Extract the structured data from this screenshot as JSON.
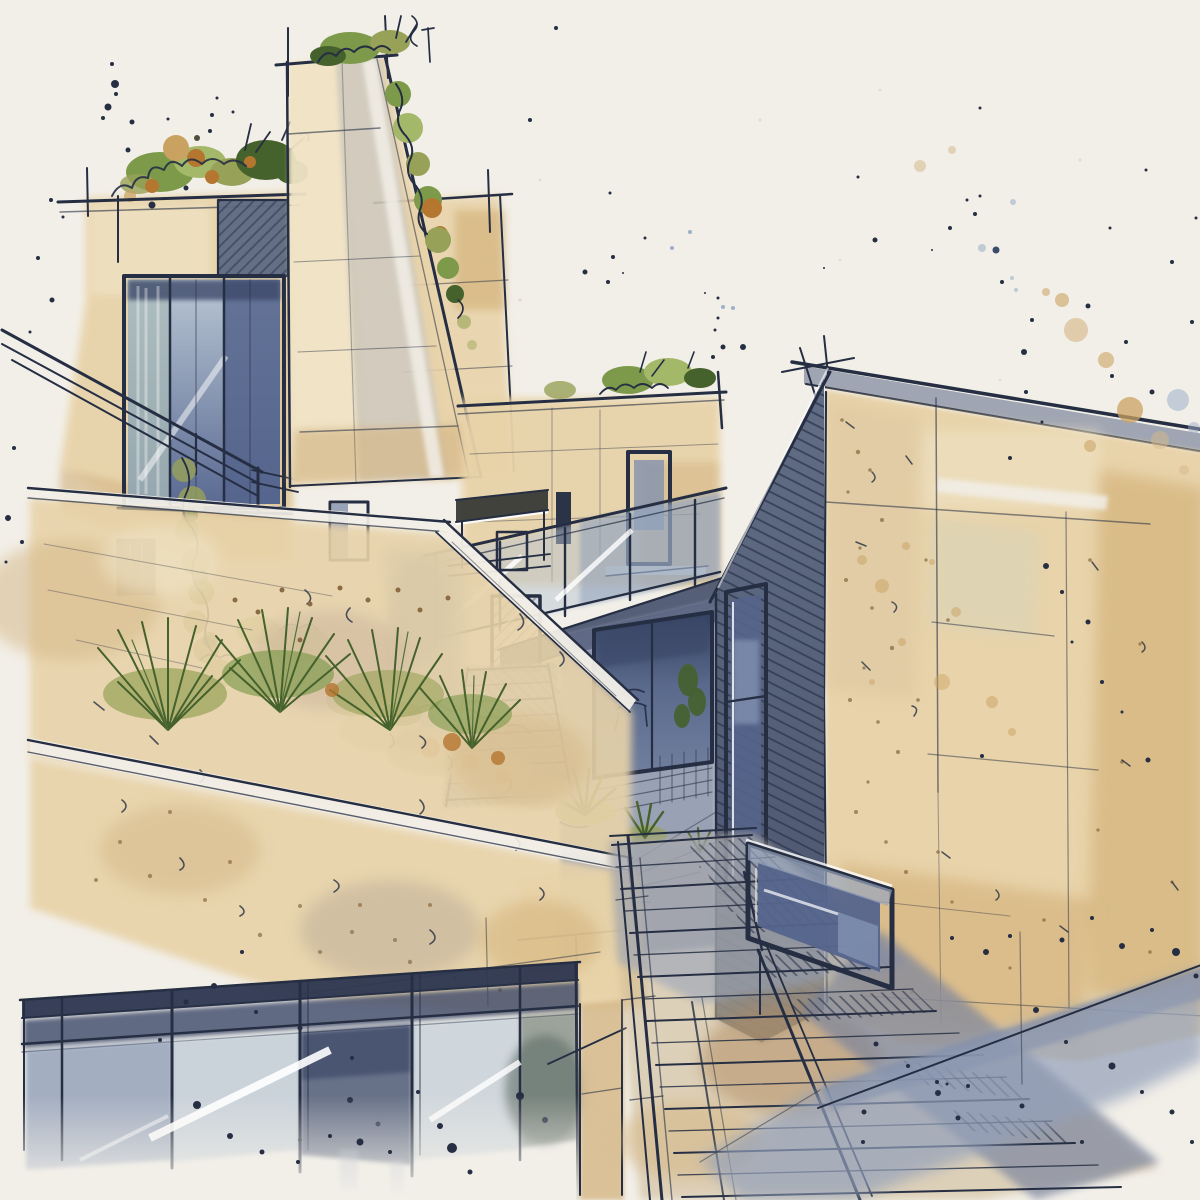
{
  "artwork": {
    "type": "watercolor architectural sketch",
    "subject": "Ink and watercolor concept sketch of a modern terraced hillside house with stacked stone volumes, a tall chimney tower, roof gardens, glass balustrades, a dark wood-clad wing and long exterior stairs",
    "style": "loose pen line work over watercolor washes with paint splatter accents on warm off-white paper",
    "text_content": "none"
  },
  "palette": {
    "paper": "#f2efe8",
    "speck": "#ddd6c6",
    "ink": "#252e42",
    "tan_light": "#f0e3c5",
    "tan": "#e8d3a9",
    "tan_deep": "#d6b98a",
    "ochre": "#c9a161",
    "rust": "#b5762f",
    "brown": "#8a6b42",
    "grey_warm": "#bcab97",
    "stone": "#cfc8ba",
    "sage": "#d9d4b8",
    "glass_pale": "#b9c6d4",
    "glass_mid": "#8295b4",
    "glass_dark": "#55648c",
    "navy": "#2c3650",
    "navy_band": "#3d4a6a",
    "clad": "#5d6983",
    "clad_dark": "#454f68",
    "clad_line": "#2e374d",
    "fascia": "#9098a8",
    "slab": "#49536e",
    "shadow_blue": "#93a0ba",
    "shadow_deep": "#76819d",
    "green_light": "#a4b86a",
    "green_mid": "#7d9a4a",
    "green_dark": "#45612c",
    "olive": "#97a157",
    "pale_dot": "#9fb0c9",
    "olive_dark": "#4a5138",
    "white": "#ffffff"
  },
  "elements": [
    {
      "name": "left-building",
      "desc": "tan block with roof planting, hatched panel, large corner glass window, stair railing, two small windows, hanging vine"
    },
    {
      "name": "center-tower",
      "desc": "tall chimney-like tower, slanted right edge with spilling vine and rooftop shrubs"
    },
    {
      "name": "companion-block",
      "desc": "upper tan volume behind the tower's slanted edge"
    },
    {
      "name": "mid-terrace-block",
      "desc": "tan facade with roof tufts, narrow dark door, glass balustrade terrace"
    },
    {
      "name": "courtyard-room",
      "desc": "recessed room with large window, chair silhouette, interior plant, yucca plants"
    },
    {
      "name": "upper-stairs",
      "desc": "narrow stair flight with awning, small window and dark door at top"
    },
    {
      "name": "rock-garden",
      "desc": "rocks and shrubs with orange accents beside the stairs"
    },
    {
      "name": "grass-planter",
      "desc": "spiky grass clumps with seed heads on the retaining wall"
    },
    {
      "name": "retaining-walls",
      "desc": "sloping concrete retaining walls with white caps and scribble texture"
    },
    {
      "name": "lower-glass-wall",
      "desc": "glass curtain wall with navy frame, mullions and diagonal glares"
    },
    {
      "name": "lower-stairs",
      "desc": "wide exterior stair flight with handrails and cast shadow"
    },
    {
      "name": "right-building",
      "desc": "large tan stone wall with faint grid, dark wood-clad angled wall, tall window and low window box"
    },
    {
      "name": "paint-splatters",
      "desc": "ink and ochre splatter clusters on the paper"
    }
  ]
}
